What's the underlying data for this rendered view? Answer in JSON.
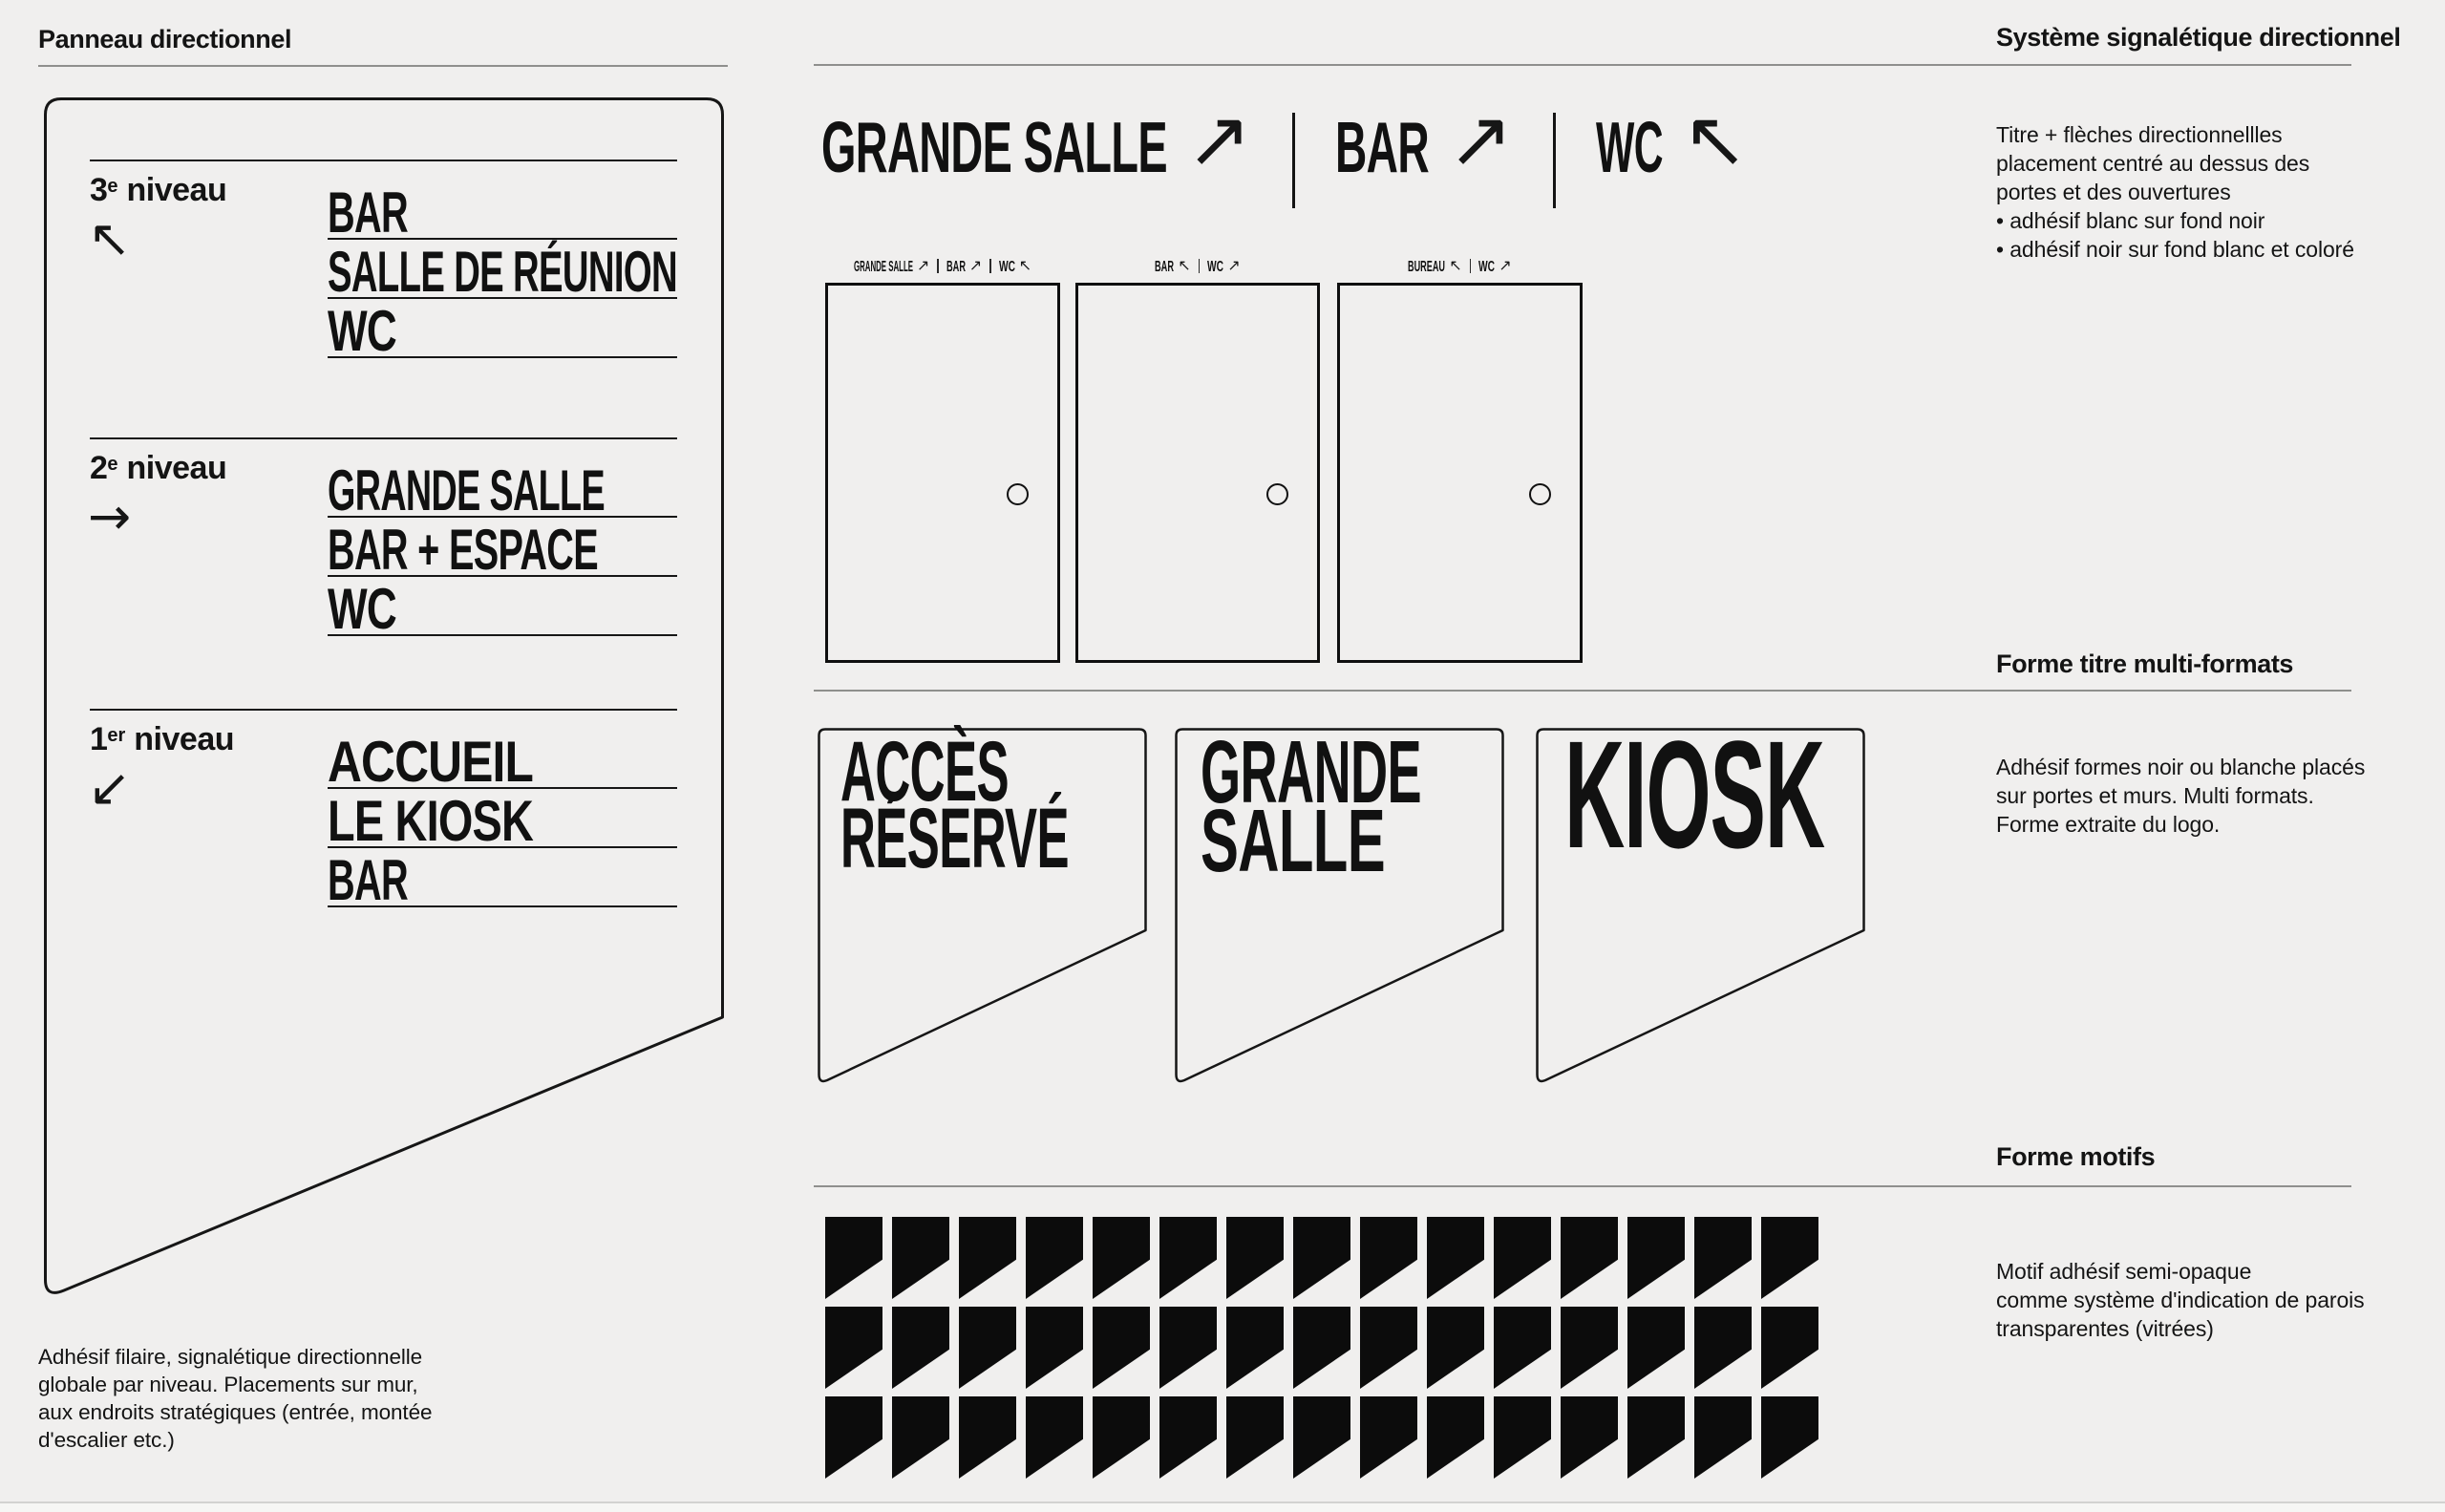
{
  "page": {
    "background": "#f0efee",
    "ink": "#141414",
    "rule_color": "#8f8f8d"
  },
  "left": {
    "heading": "Panneau directionnel",
    "panel": {
      "groups": [
        {
          "level_num": "3",
          "level_sup": "e",
          "level_word": "niveau",
          "arrow": "↖",
          "destinations": [
            "BAR",
            "SALLE DE RÉUNION",
            "WC"
          ]
        },
        {
          "level_num": "2",
          "level_sup": "e",
          "level_word": "niveau",
          "arrow": "→",
          "destinations": [
            "GRANDE SALLE",
            "BAR + ESPACE",
            "WC"
          ]
        },
        {
          "level_num": "1",
          "level_sup": "er",
          "level_word": "niveau",
          "arrow": "↙",
          "destinations": [
            "ACCUEIL",
            "LE KIOSK",
            "BAR"
          ]
        }
      ]
    },
    "caption_lines": [
      "Adhésif filaire, signalétique directionnelle",
      "globale par niveau. Placements sur mur,",
      "aux endroits stratégiques  (entrée, montée",
      "d'escalier etc.)"
    ]
  },
  "center": {
    "title": {
      "items": [
        {
          "text": "GRANDE SALLE",
          "arrow": "↗"
        },
        {
          "text": "BAR",
          "arrow": "↗"
        },
        {
          "text": "WC",
          "arrow": "↖"
        }
      ]
    },
    "doors": [
      {
        "label_items": [
          {
            "text": "GRANDE SALLE",
            "arrow": "↗"
          },
          {
            "text": "BAR",
            "arrow": "↗"
          },
          {
            "text": "WC",
            "arrow": "↖"
          }
        ]
      },
      {
        "label_items": [
          {
            "text": "BAR",
            "arrow": "↖"
          },
          {
            "text": "WC",
            "arrow": "↗"
          }
        ]
      },
      {
        "label_items": [
          {
            "text": "BUREAU",
            "arrow": "↖"
          },
          {
            "text": "WC",
            "arrow": "↗"
          }
        ]
      }
    ],
    "signs": [
      {
        "lines": [
          "ACCÈS",
          "RÉSERVÉ"
        ]
      },
      {
        "lines": [
          "GRANDE",
          "SALLE"
        ]
      },
      {
        "lines": [
          "KIOSK"
        ]
      }
    ],
    "motifs": {
      "rows": 3,
      "cols": 15
    }
  },
  "right": {
    "sections": [
      {
        "heading": "Système signalétique directionnel",
        "body": [
          "Titre + flèches directionnellles",
          "placement centré au dessus des",
          "portes et des ouvertures",
          "• adhésif blanc sur fond noir",
          "• adhésif noir sur fond blanc et coloré"
        ]
      },
      {
        "heading": "Forme titre multi-formats",
        "body": [
          "Adhésif formes noir ou blanche placés",
          "sur portes et murs. Multi formats.",
          "Forme extraite du logo."
        ]
      },
      {
        "heading": "Forme motifs",
        "body": [
          "Motif adhésif semi-opaque",
          "comme système d'indication de parois",
          "transparentes (vitrées)"
        ]
      }
    ]
  }
}
